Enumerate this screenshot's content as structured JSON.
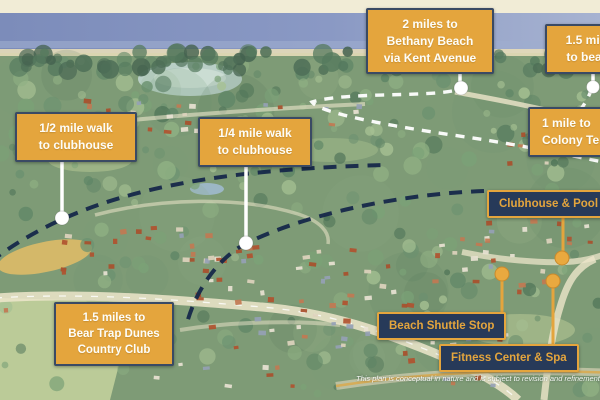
{
  "labels": {
    "gold": [
      {
        "id": "bethany-beach",
        "text": "2 miles to\nBethany Beach\nvia Kent Avenue"
      },
      {
        "id": "beach",
        "text": "1.5 miles\nto beach"
      },
      {
        "id": "half-mile-walk",
        "text": "1/2 mile walk\nto clubhouse"
      },
      {
        "id": "quarter-mile-walk",
        "text": "1/4 mile walk\nto clubhouse"
      },
      {
        "id": "colony-tennis",
        "text": "1 mile to\nColony Tennis"
      },
      {
        "id": "bear-trap",
        "text": "1.5 miles to\nBear Trap Dunes\nCountry Club"
      }
    ],
    "navy": [
      {
        "id": "clubhouse-pool",
        "text": "Clubhouse & Pool"
      },
      {
        "id": "beach-shuttle",
        "text": "Beach Shuttle Stop"
      },
      {
        "id": "fitness-spa",
        "text": "Fitness Center & Spa"
      }
    ]
  },
  "disclaimer": "This plan is conceptual in nature and is subject to revision and refinement.",
  "colors": {
    "accent_gold": "#E4A53D",
    "label_navy": "#273A59",
    "arc_navy": "#16284A",
    "route_white": "#FFFFFF"
  }
}
